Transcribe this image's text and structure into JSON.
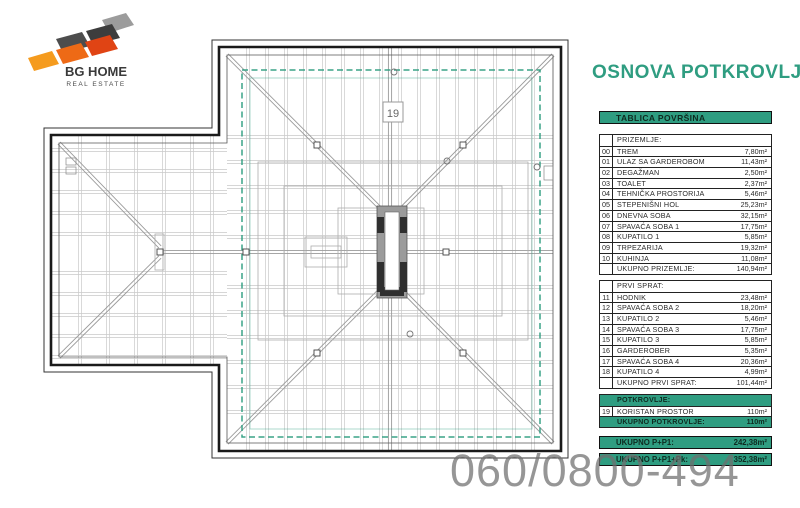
{
  "brand": {
    "name": "BG HOME",
    "subtitle": "REAL ESTATE"
  },
  "title": "OSNOVA POTKROVLJA",
  "plan": {
    "room_label": "19"
  },
  "table": {
    "header": "TABLICA POVRŠINA",
    "sections": [
      {
        "title": "PRIZEMLJE:",
        "highlight": false,
        "rows": [
          {
            "no": "00",
            "name": "TREM",
            "area": "7,80m²"
          },
          {
            "no": "01",
            "name": "ULAZ SA GARDEROBOM",
            "area": "11,43m²"
          },
          {
            "no": "02",
            "name": "DEGAŽMAN",
            "area": "2,50m²"
          },
          {
            "no": "03",
            "name": "TOALET",
            "area": "2,37m²"
          },
          {
            "no": "04",
            "name": "TEHNIČKA PROSTORIJA",
            "area": "5,46m²"
          },
          {
            "no": "05",
            "name": "STEPENIŠNI HOL",
            "area": "25,23m²"
          },
          {
            "no": "06",
            "name": "DNEVNA SOBA",
            "area": "32,15m²"
          },
          {
            "no": "07",
            "name": "SPAVAĆA SOBA 1",
            "area": "17,75m²"
          },
          {
            "no": "08",
            "name": "KUPATILO 1",
            "area": "5,85m²"
          },
          {
            "no": "09",
            "name": "TRPEZARIJA",
            "area": "19,32m²"
          },
          {
            "no": "10",
            "name": "KUHINJA",
            "area": "11,08m²"
          }
        ],
        "total_label": "UKUPNO PRIZEMLJE:",
        "total_value": "140,94m²"
      },
      {
        "title": "PRVI SPRAT:",
        "highlight": false,
        "rows": [
          {
            "no": "11",
            "name": "HODNIK",
            "area": "23,48m²"
          },
          {
            "no": "12",
            "name": "SPAVAĆA SOBA 2",
            "area": "18,20m²"
          },
          {
            "no": "13",
            "name": "KUPATILO 2",
            "area": "5,46m²"
          },
          {
            "no": "14",
            "name": "SPAVAĆA SOBA 3",
            "area": "17,75m²"
          },
          {
            "no": "15",
            "name": "KUPATILO 3",
            "area": "5,85m²"
          },
          {
            "no": "16",
            "name": "GARDEROBER",
            "area": "5,35m²"
          },
          {
            "no": "17",
            "name": "SPAVAĆA SOBA 4",
            "area": "20,36m²"
          },
          {
            "no": "18",
            "name": "KUPATILO 4",
            "area": "4,99m²"
          }
        ],
        "total_label": "UKUPNO PRVI SPRAT:",
        "total_value": "101,44m²"
      },
      {
        "title": "POTKROVLJE:",
        "highlight": true,
        "rows": [
          {
            "no": "19",
            "name": "KORISTAN PROSTOR",
            "area": "110m²"
          }
        ],
        "total_label": "UKUPNO POTKROVLJE:",
        "total_value": "110m²"
      }
    ],
    "grand_totals": [
      {
        "label": "UKUPNO P+P1:",
        "value": "242,38m²"
      },
      {
        "label": "UKUPNO P+P1+Pk:",
        "value": "352,38m²"
      }
    ]
  },
  "watermark": "060/0800-494",
  "colors": {
    "accent": "#2F9D81"
  }
}
